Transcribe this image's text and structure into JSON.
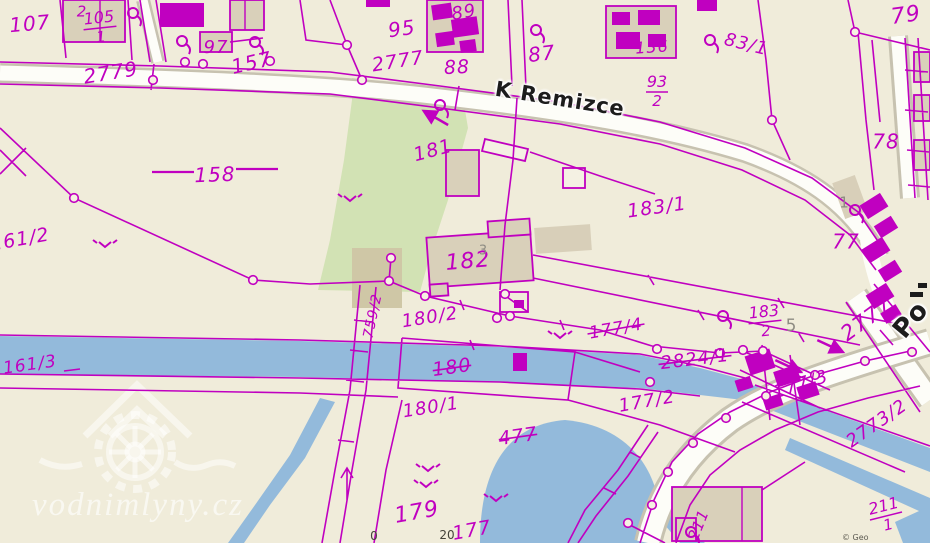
{
  "map": {
    "colors": {
      "background": "#f0ecda",
      "line": "#c000c0",
      "water": "#93badb",
      "green": "#d2e2b4",
      "road_fill": "#fdfdf8",
      "road_casing": "#c7c2b0",
      "building_tan": "#d9d0ba",
      "building_light": "#f4f1e3",
      "patch_tan": "#d8cfb9",
      "patch_olive": "#cfc7a6",
      "gray_label": "#8e8c83",
      "street_text": "#1c1c1c"
    },
    "street_labels": [
      {
        "text": "K Remizce",
        "x": 560,
        "y": 99,
        "rot": 9,
        "size": 21
      },
      {
        "text": "Po",
        "x": 911,
        "y": 320,
        "rot": -50,
        "size": 26
      }
    ],
    "watermark": {
      "text": "vodnimlyny.cz"
    },
    "copyright": {
      "text": "© Geo"
    },
    "scale_labels": [
      {
        "text": "0",
        "x": 374,
        "y": 536
      },
      {
        "text": "20",
        "x": 447,
        "y": 535
      }
    ],
    "parcel_labels": [
      {
        "t": "107",
        "x": 30,
        "y": 25,
        "r": -5,
        "s": 20
      },
      {
        "t": "2",
        "x": 82,
        "y": 12,
        "r": 0,
        "s": 15
      },
      {
        "t": "97",
        "x": 216,
        "y": 48,
        "r": 0,
        "s": 18
      },
      {
        "t": "2779",
        "x": 111,
        "y": 74,
        "r": -9,
        "s": 20
      },
      {
        "t": "157",
        "x": 252,
        "y": 64,
        "r": -13,
        "s": 20
      },
      {
        "t": "158",
        "x": 215,
        "y": 176,
        "r": -2,
        "s": 20
      },
      {
        "t": "95",
        "x": 402,
        "y": 30,
        "r": -8,
        "s": 20
      },
      {
        "t": "2777",
        "x": 398,
        "y": 62,
        "r": -9,
        "s": 19
      },
      {
        "t": "88",
        "x": 457,
        "y": 68,
        "r": -3,
        "s": 19
      },
      {
        "t": "89",
        "x": 464,
        "y": 13,
        "r": -10,
        "s": 18
      },
      {
        "t": "87",
        "x": 542,
        "y": 55,
        "r": -7,
        "s": 20
      },
      {
        "t": "181",
        "x": 433,
        "y": 151,
        "r": -15,
        "s": 19
      },
      {
        "t": "183/1",
        "x": 657,
        "y": 208,
        "r": -8,
        "s": 19
      },
      {
        "t": "83/1",
        "x": 746,
        "y": 45,
        "r": 14,
        "s": 18
      },
      {
        "t": "136",
        "x": 652,
        "y": 48,
        "r": -4,
        "s": 16
      },
      {
        "t": "79",
        "x": 906,
        "y": 16,
        "r": -8,
        "s": 22
      },
      {
        "t": "78",
        "x": 886,
        "y": 143,
        "r": 0,
        "s": 20
      },
      {
        "t": "77",
        "x": 846,
        "y": 243,
        "r": 0,
        "s": 20
      },
      {
        "t": "182",
        "x": 468,
        "y": 262,
        "r": -5,
        "s": 22
      },
      {
        "t": "161/2",
        "x": 20,
        "y": 240,
        "r": -10,
        "s": 19
      },
      {
        "t": "161/3",
        "x": 30,
        "y": 365,
        "r": -8,
        "s": 17
      },
      {
        "t": "759/2",
        "x": 373,
        "y": 316,
        "r": -78,
        "s": 14
      },
      {
        "t": "180/2",
        "x": 430,
        "y": 318,
        "r": -9,
        "s": 18
      },
      {
        "t": "180",
        "x": 452,
        "y": 368,
        "r": -8,
        "s": 19,
        "strike": 1
      },
      {
        "t": "180/1",
        "x": 431,
        "y": 408,
        "r": -9,
        "s": 18
      },
      {
        "t": "477",
        "x": 518,
        "y": 437,
        "r": -8,
        "s": 19,
        "strike": 1
      },
      {
        "t": "177/4",
        "x": 616,
        "y": 329,
        "r": -10,
        "s": 17,
        "strike": 1
      },
      {
        "t": "2824/1",
        "x": 695,
        "y": 360,
        "r": -7,
        "s": 18,
        "strike": 1
      },
      {
        "t": "177/2",
        "x": 647,
        "y": 402,
        "r": -10,
        "s": 18
      },
      {
        "t": "177/3",
        "x": 801,
        "y": 385,
        "r": -18,
        "s": 18
      },
      {
        "t": "2773/2",
        "x": 877,
        "y": 424,
        "r": -35,
        "s": 18
      },
      {
        "t": "2777",
        "x": 867,
        "y": 320,
        "r": -36,
        "s": 21
      },
      {
        "t": "179",
        "x": 417,
        "y": 513,
        "r": -10,
        "s": 22
      },
      {
        "t": "177",
        "x": 472,
        "y": 531,
        "r": -10,
        "s": 19
      },
      {
        "t": "211",
        "x": 699,
        "y": 525,
        "r": -68,
        "s": 15
      }
    ],
    "fraction_labels": [
      {
        "num": "105",
        "den": "1",
        "x": 100,
        "y": 28,
        "r": -6
      },
      {
        "num": "93",
        "den": "2",
        "x": 657,
        "y": 92,
        "r": 0
      },
      {
        "num": "183",
        "den": "2",
        "x": 765,
        "y": 322,
        "r": -6
      },
      {
        "num": "211",
        "den": "1",
        "x": 886,
        "y": 516,
        "r": -14
      }
    ],
    "gray_labels": [
      {
        "t": "1",
        "x": 844,
        "y": 203,
        "s": 15
      },
      {
        "t": "5",
        "x": 791,
        "y": 326,
        "s": 17
      },
      {
        "t": "3",
        "x": 483,
        "y": 251,
        "s": 13
      }
    ],
    "symbols": {
      "tree": [
        [
          133,
          13
        ],
        [
          182,
          41
        ],
        [
          255,
          42
        ],
        [
          536,
          30
        ],
        [
          710,
          40
        ],
        [
          855,
          210
        ],
        [
          723,
          316
        ],
        [
          440,
          105
        ],
        [
          691,
          532
        ]
      ],
      "slope": [
        [
          105,
          242
        ],
        [
          350,
          196
        ],
        [
          428,
          466
        ],
        [
          426,
          482
        ],
        [
          496,
          496
        ],
        [
          560,
          333
        ]
      ],
      "arrow": [
        [
          788,
          366,
          25
        ],
        [
          830,
          346,
          25
        ],
        [
          436,
          118,
          210
        ]
      ]
    },
    "nodes": [
      [
        153,
        80
      ],
      [
        185,
        62
      ],
      [
        203,
        64
      ],
      [
        270,
        61
      ],
      [
        362,
        80
      ],
      [
        347,
        45
      ],
      [
        74,
        198
      ],
      [
        253,
        280
      ],
      [
        389,
        281
      ],
      [
        391,
        258
      ],
      [
        425,
        296
      ],
      [
        510,
        316
      ],
      [
        505,
        294
      ],
      [
        497,
        318
      ],
      [
        657,
        349
      ],
      [
        743,
        350
      ],
      [
        650,
        382
      ],
      [
        720,
        353
      ],
      [
        763,
        351
      ],
      [
        855,
        32
      ],
      [
        772,
        120
      ],
      [
        628,
        523
      ],
      [
        652,
        505
      ],
      [
        668,
        472
      ],
      [
        693,
        443
      ],
      [
        726,
        418
      ],
      [
        766,
        396
      ],
      [
        815,
        375
      ],
      [
        865,
        361
      ],
      [
        912,
        352
      ]
    ],
    "buildings": [
      {
        "x": 63,
        "y": 0,
        "w": 62,
        "h": 42,
        "r": 0,
        "k": "tan"
      },
      {
        "x": 230,
        "y": 0,
        "w": 34,
        "h": 30,
        "r": 0,
        "k": "tan"
      },
      {
        "x": 200,
        "y": 32,
        "w": 32,
        "h": 20,
        "r": 0,
        "k": "tan"
      },
      {
        "x": 427,
        "y": 0,
        "w": 56,
        "h": 52,
        "r": 0,
        "k": "tan"
      },
      {
        "x": 606,
        "y": 6,
        "w": 70,
        "h": 52,
        "r": 0,
        "k": "tan"
      },
      {
        "x": 446,
        "y": 150,
        "w": 33,
        "h": 46,
        "r": 0,
        "k": "tan"
      },
      {
        "x": 563,
        "y": 168,
        "w": 22,
        "h": 20,
        "r": 0,
        "k": "light"
      },
      {
        "x": 428,
        "y": 234,
        "w": 104,
        "h": 50,
        "r": -4,
        "k": "tan"
      },
      {
        "x": 488,
        "y": 220,
        "w": 42,
        "h": 16,
        "r": -4,
        "k": "tan"
      },
      {
        "x": 430,
        "y": 284,
        "w": 18,
        "h": 12,
        "r": -4,
        "k": "tan"
      },
      {
        "x": 672,
        "y": 487,
        "w": 90,
        "h": 54,
        "r": 0,
        "k": "tan"
      },
      {
        "x": 676,
        "y": 518,
        "w": 20,
        "h": 23,
        "r": 0,
        "k": "tan"
      },
      {
        "x": 838,
        "y": 178,
        "w": 24,
        "h": 38,
        "r": -20,
        "k": "patch"
      },
      {
        "x": 914,
        "y": 52,
        "w": 16,
        "h": 30,
        "r": 0,
        "k": "tan"
      },
      {
        "x": 914,
        "y": 95,
        "w": 16,
        "h": 26,
        "r": 0,
        "k": "tan"
      },
      {
        "x": 914,
        "y": 140,
        "w": 16,
        "h": 30,
        "r": 0,
        "k": "tan"
      },
      {
        "x": 535,
        "y": 226,
        "w": 56,
        "h": 26,
        "r": -4,
        "k": "patch"
      },
      {
        "x": 352,
        "y": 248,
        "w": 50,
        "h": 60,
        "r": 0,
        "k": "olive"
      },
      {
        "x": 500,
        "y": 292,
        "w": 28,
        "h": 20,
        "r": 0,
        "k": "outline"
      },
      {
        "x": 160,
        "y": 3,
        "w": 44,
        "h": 24,
        "r": 0,
        "k": "solid"
      },
      {
        "x": 432,
        "y": 4,
        "w": 20,
        "h": 15,
        "r": -8,
        "k": "solid"
      },
      {
        "x": 452,
        "y": 18,
        "w": 26,
        "h": 18,
        "r": -8,
        "k": "solid"
      },
      {
        "x": 436,
        "y": 32,
        "w": 18,
        "h": 14,
        "r": -8,
        "k": "solid"
      },
      {
        "x": 460,
        "y": 40,
        "w": 16,
        "h": 12,
        "r": -8,
        "k": "solid"
      },
      {
        "x": 612,
        "y": 12,
        "w": 18,
        "h": 13,
        "r": 0,
        "k": "solid"
      },
      {
        "x": 638,
        "y": 10,
        "w": 22,
        "h": 15,
        "r": 0,
        "k": "solid"
      },
      {
        "x": 616,
        "y": 32,
        "w": 24,
        "h": 17,
        "r": 0,
        "k": "solid"
      },
      {
        "x": 648,
        "y": 34,
        "w": 18,
        "h": 13,
        "r": 0,
        "k": "solid"
      },
      {
        "x": 697,
        "y": 0,
        "w": 20,
        "h": 11,
        "r": 0,
        "k": "solid"
      },
      {
        "x": 366,
        "y": 0,
        "w": 24,
        "h": 7,
        "r": 0,
        "k": "solid"
      },
      {
        "x": 862,
        "y": 198,
        "w": 24,
        "h": 16,
        "r": -32,
        "k": "solid"
      },
      {
        "x": 876,
        "y": 220,
        "w": 20,
        "h": 14,
        "r": -32,
        "k": "solid"
      },
      {
        "x": 864,
        "y": 242,
        "w": 24,
        "h": 16,
        "r": -32,
        "k": "solid"
      },
      {
        "x": 880,
        "y": 264,
        "w": 20,
        "h": 14,
        "r": -32,
        "k": "solid"
      },
      {
        "x": 868,
        "y": 288,
        "w": 24,
        "h": 16,
        "r": -32,
        "k": "solid"
      },
      {
        "x": 882,
        "y": 308,
        "w": 18,
        "h": 12,
        "r": -32,
        "k": "solid"
      },
      {
        "x": 747,
        "y": 352,
        "w": 26,
        "h": 20,
        "r": -18,
        "k": "solid"
      },
      {
        "x": 775,
        "y": 368,
        "w": 24,
        "h": 16,
        "r": -18,
        "k": "solid"
      },
      {
        "x": 798,
        "y": 384,
        "w": 20,
        "h": 14,
        "r": -18,
        "k": "solid"
      },
      {
        "x": 736,
        "y": 378,
        "w": 16,
        "h": 12,
        "r": -18,
        "k": "solid"
      },
      {
        "x": 764,
        "y": 396,
        "w": 18,
        "h": 12,
        "r": -18,
        "k": "solid"
      },
      {
        "x": 513,
        "y": 353,
        "w": 14,
        "h": 18,
        "r": 0,
        "k": "solid"
      },
      {
        "x": 514,
        "y": 300,
        "w": 10,
        "h": 8,
        "r": 0,
        "k": "solid"
      }
    ]
  }
}
